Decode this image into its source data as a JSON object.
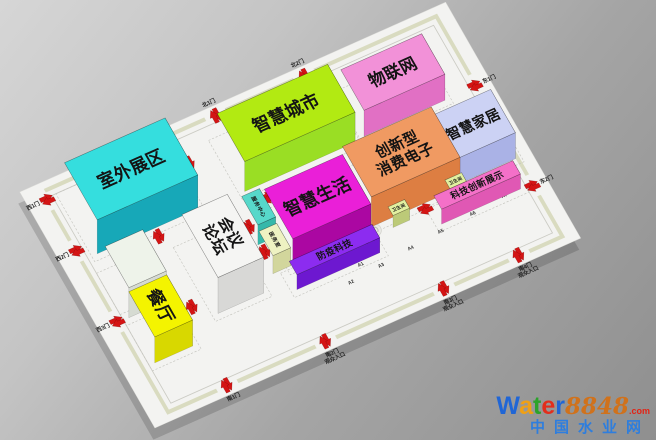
{
  "floor": {
    "slab_color": "#f3f3f1",
    "wall_color": "#d9dbc0",
    "ring_color": "#cbcbc4",
    "zone_outline_color": "#c3c3bd",
    "arrow_color": "#d41414",
    "label_color": "#141414",
    "gate_label_color": "#222222"
  },
  "blocks": [
    {
      "id": "outdoor-exhibition",
      "label": "室外展区",
      "x": 40,
      "y": 30,
      "w": 255,
      "d": 145,
      "h": 34,
      "top": "#35dede",
      "south": "#17a8b8",
      "east": "#10bccb",
      "fs": 40,
      "rot": 0,
      "outline": 1
    },
    {
      "id": "smart-city",
      "label": "智慧城市",
      "x": 410,
      "y": 60,
      "w": 280,
      "d": 122,
      "h": 30,
      "top": "#b2ea12",
      "south": "#9ade24",
      "east": "#7cc400",
      "fs": 40,
      "rot": 0,
      "outline": 1
    },
    {
      "id": "iot",
      "label": "物联网",
      "x": 715,
      "y": 75,
      "w": 205,
      "d": 103,
      "h": 26,
      "top": "#f291d8",
      "south": "#e170c4",
      "east": "#d55cb4",
      "fs": 38,
      "rot": 0,
      "outline": 1
    },
    {
      "id": "consumer-electronics",
      "label": "创新型\n消费电子",
      "x": 625,
      "y": 240,
      "w": 225,
      "d": 128,
      "h": 30,
      "top": "#f09a62",
      "south": "#dd7e42",
      "east": "#cf6d34",
      "fs": 34,
      "rot": 0,
      "outline": 1
    },
    {
      "id": "smart-home",
      "label": "智慧家居",
      "x": 845,
      "y": 250,
      "w": 150,
      "d": 110,
      "h": 26,
      "top": "#ccd2f4",
      "south": "#aab2e6",
      "east": "#98a2dc",
      "fs": 32,
      "rot": 0,
      "outline": 1
    },
    {
      "id": "tech-innovation-display",
      "label": "科技创新展示",
      "x": 770,
      "y": 392,
      "w": 200,
      "d": 34,
      "h": 15,
      "top": "#f470c8",
      "south": "#e058b4",
      "east": "#d148a6",
      "fs": 21,
      "rot": 0,
      "outline": 1
    },
    {
      "id": "smart-life",
      "label": "智慧生活",
      "x": 420,
      "y": 252,
      "w": 198,
      "d": 126,
      "h": 28,
      "top": "#ea1fd8",
      "south": "#ab07a2",
      "east": "#7c0476",
      "fs": 40,
      "rot": 0,
      "outline": 1
    },
    {
      "id": "epidemic-prevention-tech",
      "label": "防疫科技",
      "x": 402,
      "y": 394,
      "w": 210,
      "d": 34,
      "h": 15,
      "top": "#8c2cf0",
      "south": "#6d18d0",
      "east": "#5c10b8",
      "fs": 21,
      "rot": 0,
      "outline": 1
    },
    {
      "id": "conference-forum",
      "label": "会议\n论坛",
      "x": 215,
      "y": 245,
      "w": 115,
      "d": 160,
      "h": 36,
      "top": "#f5f5f3",
      "south": "#d8d8d6",
      "east": "#c9c9c7",
      "fs": 36,
      "rot": 90,
      "outline": 1
    },
    {
      "id": "restaurant-annex",
      "label": "",
      "x": 30,
      "y": 228,
      "w": 95,
      "d": 105,
      "h": 30,
      "top": "#eef3ea",
      "south": "#d6dbd2",
      "east": "#c9cec6",
      "fs": 0,
      "rot": 0,
      "outline": 1
    },
    {
      "id": "restaurant",
      "label": "餐厅",
      "x": 30,
      "y": 333,
      "w": 96,
      "d": 115,
      "h": 26,
      "top": "#f4f400",
      "south": "#d8d800",
      "east": "#c2c200",
      "fs": 40,
      "rot": 90,
      "outline": 1
    },
    {
      "id": "service-center",
      "label": "服务中心",
      "x": 375,
      "y": 230,
      "w": 45,
      "d": 72,
      "h": 20,
      "top": "#57d8ca",
      "south": "#36b8aa",
      "east": "#2aa698",
      "fs": 12,
      "rot": 90,
      "outline": 0
    },
    {
      "id": "medical-room",
      "label": "医务室",
      "x": 372,
      "y": 312,
      "w": 45,
      "d": 62,
      "h": 18,
      "top": "#eef2c2",
      "south": "#d2d69c",
      "east": "#c2c68c",
      "fs": 12,
      "rot": 90,
      "outline": 0
    },
    {
      "id": "restroom-kiosk-1",
      "label": "卫生间",
      "x": 668,
      "y": 367,
      "w": 42,
      "d": 22,
      "h": 12,
      "top": "#e2f0a0",
      "south": "#bcca78",
      "east": "#aab86a",
      "fs": 10,
      "rot": 0,
      "outline": 0
    },
    {
      "id": "restroom-kiosk-2",
      "label": "卫生间",
      "x": 814,
      "y": 364,
      "w": 42,
      "d": 22,
      "h": 12,
      "top": "#e2f0a0",
      "south": "#bcca78",
      "east": "#aab86a",
      "fs": 10,
      "rot": 0,
      "outline": 0
    }
  ],
  "gates": [
    {
      "id": "west-gate-1",
      "wall": "W",
      "pos": 20,
      "label": "西1门",
      "sub": ""
    },
    {
      "id": "west-gate-2",
      "wall": "W",
      "pos": 150,
      "label": "西2门",
      "sub": ""
    },
    {
      "id": "west-gate-3",
      "wall": "W",
      "pos": 330,
      "label": "西3门",
      "sub": ""
    },
    {
      "id": "north-gate-1",
      "wall": "N",
      "pos": 440,
      "label": "北1门",
      "sub": ""
    },
    {
      "id": "north-gate-2",
      "wall": "N",
      "pos": 665,
      "label": "北2门",
      "sub": ""
    },
    {
      "id": "east-gate-1",
      "wall": "E",
      "pos": 175,
      "label": "东1门",
      "sub": ""
    },
    {
      "id": "east-gate-2",
      "wall": "E",
      "pos": 430,
      "label": "东2门",
      "sub": ""
    },
    {
      "id": "south-gate-1",
      "wall": "S",
      "pos": 150,
      "label": "南1门",
      "sub": ""
    },
    {
      "id": "south-gate-2",
      "wall": "S",
      "pos": 400,
      "label": "南2门",
      "sub": "观众入口"
    },
    {
      "id": "south-gate-3",
      "wall": "S",
      "pos": 700,
      "label": "南3门",
      "sub": "观众入口"
    },
    {
      "id": "south-gate-4",
      "wall": "S",
      "pos": 890,
      "label": "南4门",
      "sub": "观众入口"
    }
  ],
  "aisle_markers": [
    {
      "label": "A1",
      "x": 455,
      "y": 382
    },
    {
      "label": "A1",
      "x": 560,
      "y": 438
    },
    {
      "label": "A2",
      "x": 520,
      "y": 465
    },
    {
      "label": "A3",
      "x": 600,
      "y": 458
    },
    {
      "label": "A4",
      "x": 680,
      "y": 450
    },
    {
      "label": "A5",
      "x": 760,
      "y": 443
    },
    {
      "label": "A6",
      "x": 845,
      "y": 436
    },
    {
      "label": "A7",
      "x": 930,
      "y": 428
    }
  ],
  "arrows": [
    {
      "x": 330,
      "y": 75,
      "r": 90
    },
    {
      "x": 815,
      "y": 40,
      "r": 0
    },
    {
      "x": 700,
      "y": 205,
      "r": 0
    },
    {
      "x": 450,
      "y": 215,
      "r": 0
    },
    {
      "x": 940,
      "y": 215,
      "r": 90
    },
    {
      "x": 620,
      "y": 300,
      "r": 90
    },
    {
      "x": 378,
      "y": 258,
      "r": 90
    },
    {
      "x": 381,
      "y": 322,
      "r": 90
    },
    {
      "x": 185,
      "y": 195,
      "r": 90
    },
    {
      "x": 170,
      "y": 368,
      "r": 90
    },
    {
      "x": 600,
      "y": 386,
      "r": 0
    },
    {
      "x": 755,
      "y": 380,
      "r": 0
    }
  ],
  "floor_logos": [
    {
      "x": 628,
      "y": 377
    },
    {
      "x": 905,
      "y": 372
    }
  ],
  "watermark": {
    "word": [
      {
        "ch": "W",
        "color": "#2066d6"
      },
      {
        "ch": "a",
        "color": "#f0a014"
      },
      {
        "ch": "t",
        "color": "#2ba32b"
      },
      {
        "ch": "e",
        "color": "#e22e1c"
      },
      {
        "ch": "r",
        "color": "#2066d6"
      }
    ],
    "num": "8848",
    "num_color": "#d0721c",
    "dot": ".com",
    "dot_color": "#e22416",
    "line2": "中国水业网",
    "line2_color": "#2e7ede"
  }
}
